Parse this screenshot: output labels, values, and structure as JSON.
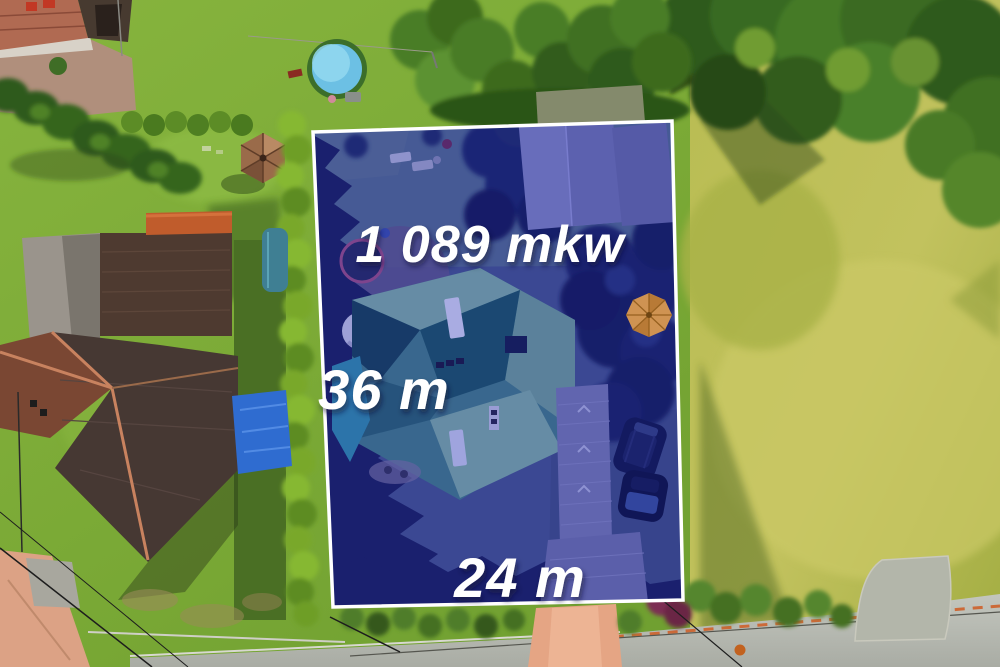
{
  "photo": {
    "kind": "aerial-drone-view-of-residential-plot",
    "plot": {
      "area_label": "1 089 mkw",
      "depth_label": "36 m",
      "width_label": "24 m",
      "label_color": "#ffffff",
      "boundary_color": "#ffffff",
      "highlight_fill": "rgba(25,27,168,0.33)"
    },
    "objects": [
      "plot-boundary-outline",
      "teal-roof-house",
      "garden-shed",
      "driveway",
      "parked-car",
      "parked-car",
      "patio-umbrella",
      "satellite-dish",
      "trampoline",
      "swimming-pool",
      "gazebo",
      "workshop-building",
      "neighbor-house-northwest",
      "neighbor-house-southwest",
      "blue-tarp",
      "tall-hedges",
      "meadow",
      "tree-line",
      "road",
      "footpaths",
      "power-lines"
    ]
  }
}
